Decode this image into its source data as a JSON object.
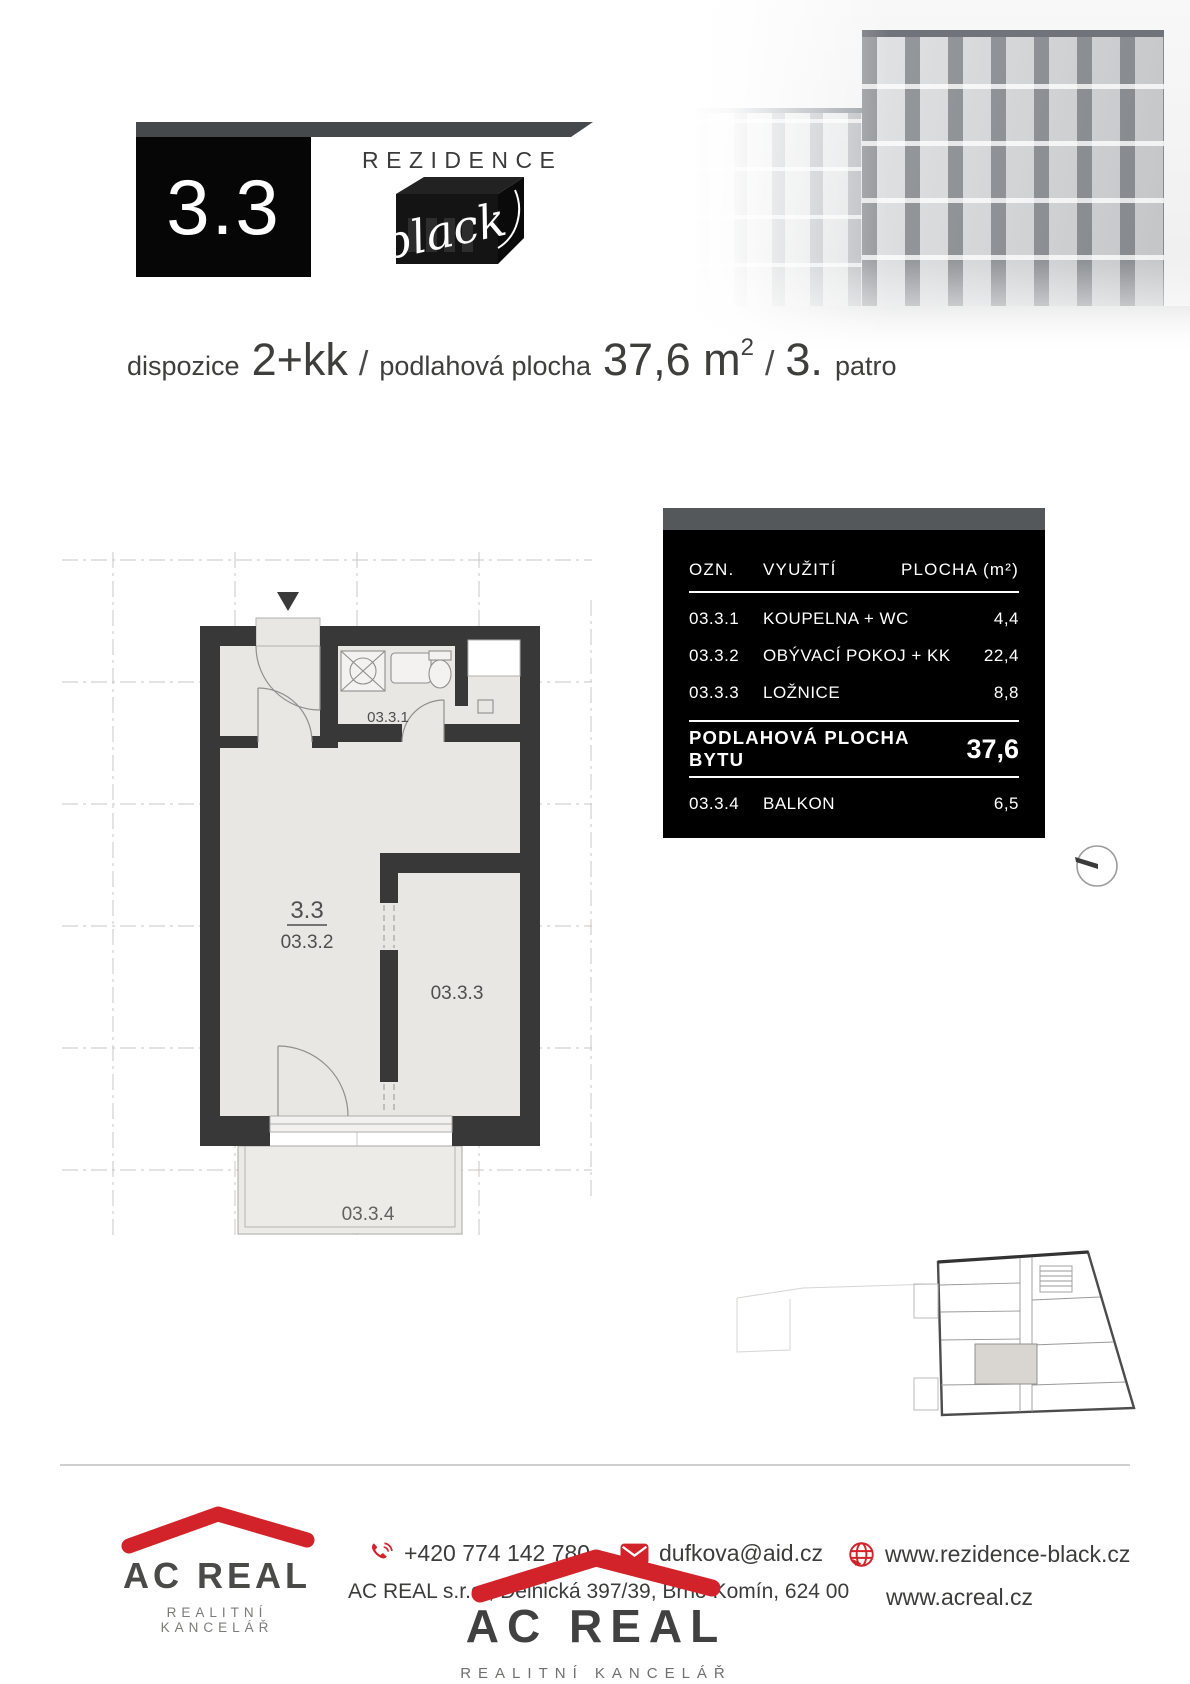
{
  "colors": {
    "accent_red": "#d2232a",
    "wall_dark": "#383838",
    "table_black": "#000000",
    "bar_gray": "#46494c"
  },
  "header": {
    "unit_number": "3.3",
    "brand_name": "REZIDENCE",
    "brand_script": "black"
  },
  "subtitle": {
    "label_layout": "dispozice",
    "value_layout": "2+kk",
    "separator": "/",
    "label_area": "podlahová plocha",
    "value_area": "37,6 m",
    "value_area_sup": "2",
    "value_floor": "3.",
    "label_floor": "patro"
  },
  "table": {
    "header": {
      "ozn": "OZN.",
      "use": "VYUŽITÍ",
      "area": "PLOCHA (m²)"
    },
    "rows": [
      {
        "ozn": "03.3.1",
        "use": "KOUPELNA + WC",
        "area": "4,4"
      },
      {
        "ozn": "03.3.2",
        "use": "OBÝVACÍ POKOJ + KK",
        "area": "22,4"
      },
      {
        "ozn": "03.3.3",
        "use": "LOŽNICE",
        "area": "8,8"
      }
    ],
    "total": {
      "label": "PODLAHOVÁ PLOCHA BYTU",
      "value": "37,6"
    },
    "balcony": {
      "ozn": "03.3.4",
      "use": "BALKON",
      "area": "6,5"
    }
  },
  "floorplan": {
    "labels": {
      "unit": "3.3",
      "living": "03.3.2",
      "bathroom": "03.3.1",
      "bedroom": "03.3.3",
      "balcony": "03.3.4"
    },
    "icons": {
      "entrance": "entrance-arrow-icon",
      "compass": "compass-icon"
    }
  },
  "footer": {
    "logo": {
      "company": "AC REAL",
      "tagline": "REALITNÍ KANCELÁŘ"
    },
    "phone": "+420 774 142 780",
    "email": "dufkova@aid.cz",
    "address": "AC REAL s.r.o., Dělnická 397/39, Brno Komín, 624 00",
    "website_project": "www.rezidence-black.cz",
    "website_company": "www.acreal.cz",
    "center_logo": {
      "company": "AC REAL",
      "tagline": "REALITNÍ KANCELÁŘ"
    },
    "icons": {
      "phone": "phone-icon",
      "email": "envelope-icon",
      "web": "globe-icon"
    }
  }
}
